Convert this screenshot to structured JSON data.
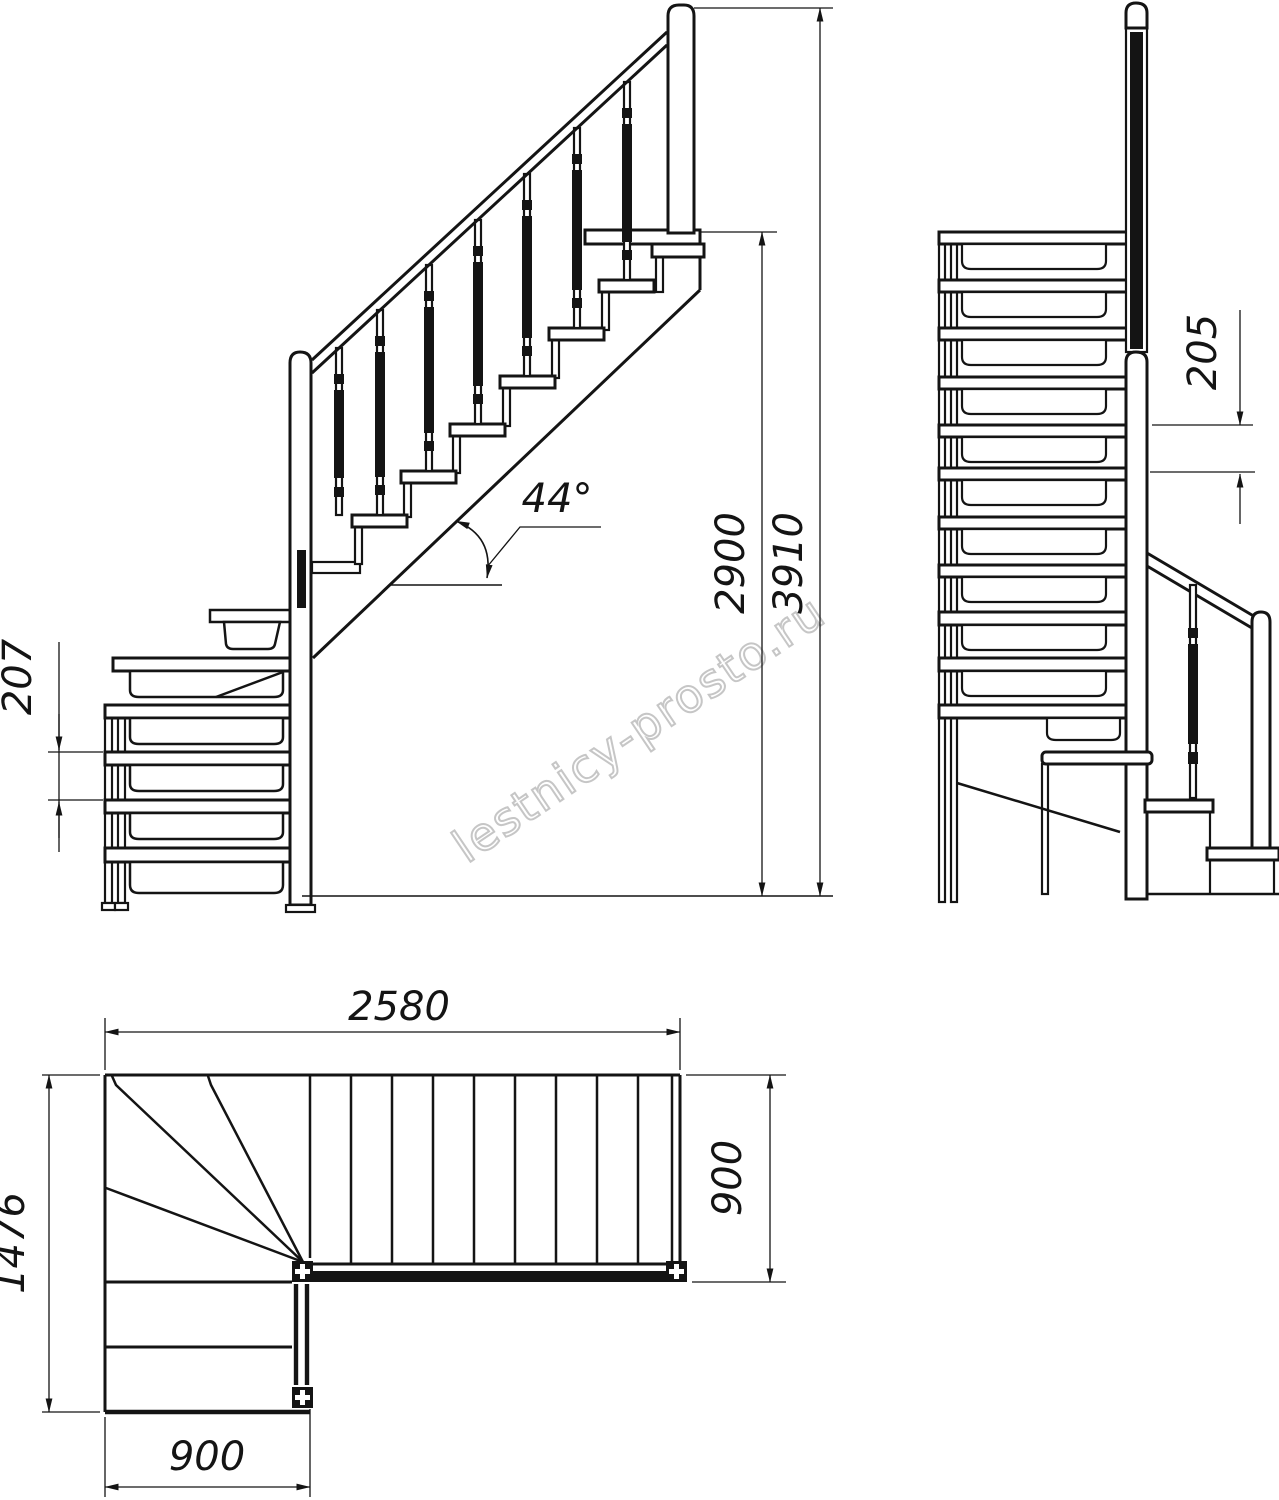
{
  "watermark": {
    "text": "lestnicy-prosto.ru",
    "color": "#c6c6c6"
  },
  "colors": {
    "line": "#141414",
    "background": "#ffffff"
  },
  "views": {
    "side_elevation": {
      "dimensions": {
        "step_rise": "207",
        "incline_angle": "44°",
        "landing_height": "2900",
        "total_height": "3910"
      }
    },
    "front_elevation": {
      "dimensions": {
        "step_rise": "205"
      }
    },
    "plan": {
      "dimensions": {
        "total_run": "2580",
        "upper_flight_width": "900",
        "total_depth": "1476",
        "lower_flight_width": "900"
      }
    }
  }
}
